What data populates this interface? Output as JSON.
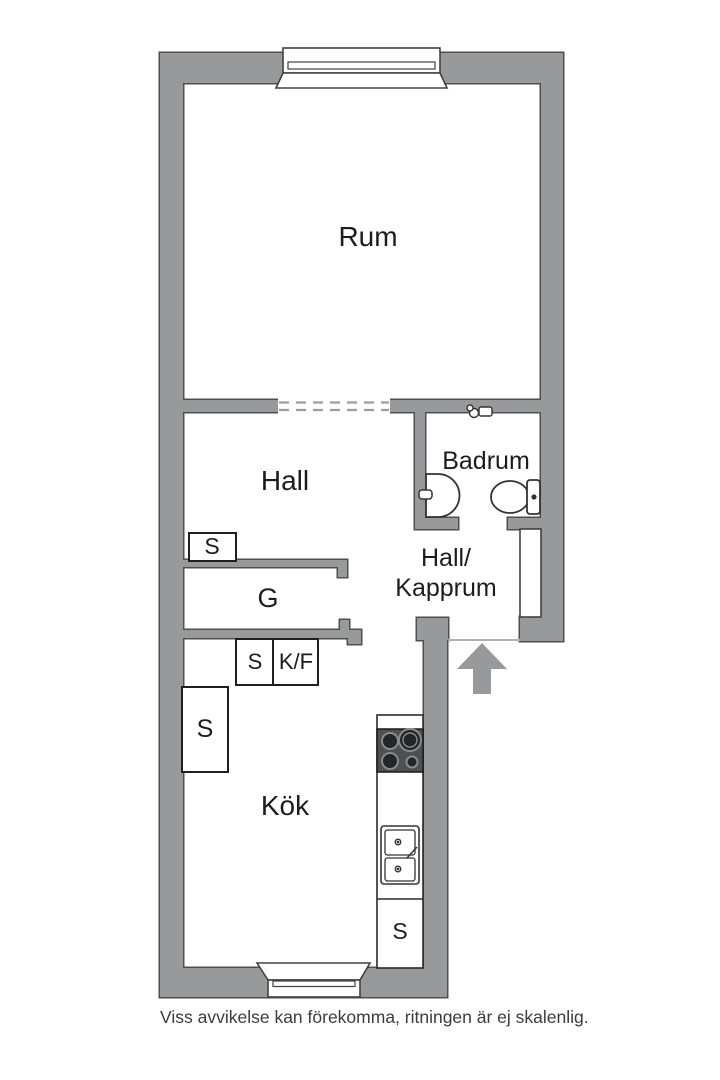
{
  "colors": {
    "wall_fill": "#97999b",
    "wall_outline": "#4d4f51",
    "fixture_stroke": "#333333",
    "stove_body": "#4e4f51",
    "burner_fill": "#242526",
    "burner_ring": "#8a8b8d",
    "label_text": "#1c1c1e",
    "dashed_opening": "#9b9da0"
  },
  "rooms": {
    "rum": "Rum",
    "hall": "Hall",
    "badrum": "Badrum",
    "hall_kapprum_line1": "Hall/",
    "hall_kapprum_line2": "Kapprum",
    "kok": "Kök"
  },
  "storage": {
    "hall_closet": "S",
    "wardrobe": "G",
    "closet_small": "S",
    "fridge_freezer": "K/F",
    "kitchen_closet": "S",
    "counter_closet": "S"
  },
  "icons": {
    "top_window": "window-icon",
    "bottom_window": "window-icon",
    "stove": "stove-icon",
    "kitchen_sink": "double-sink-icon",
    "bathroom_sink": "washbasin-icon",
    "toilet": "toilet-icon",
    "mixer": "faucet-icon",
    "entrance": "entrance-arrow-icon"
  },
  "footer": {
    "disclaimer": "Viss avvikelse kan förekomma, ritningen är ej skalenlig."
  }
}
